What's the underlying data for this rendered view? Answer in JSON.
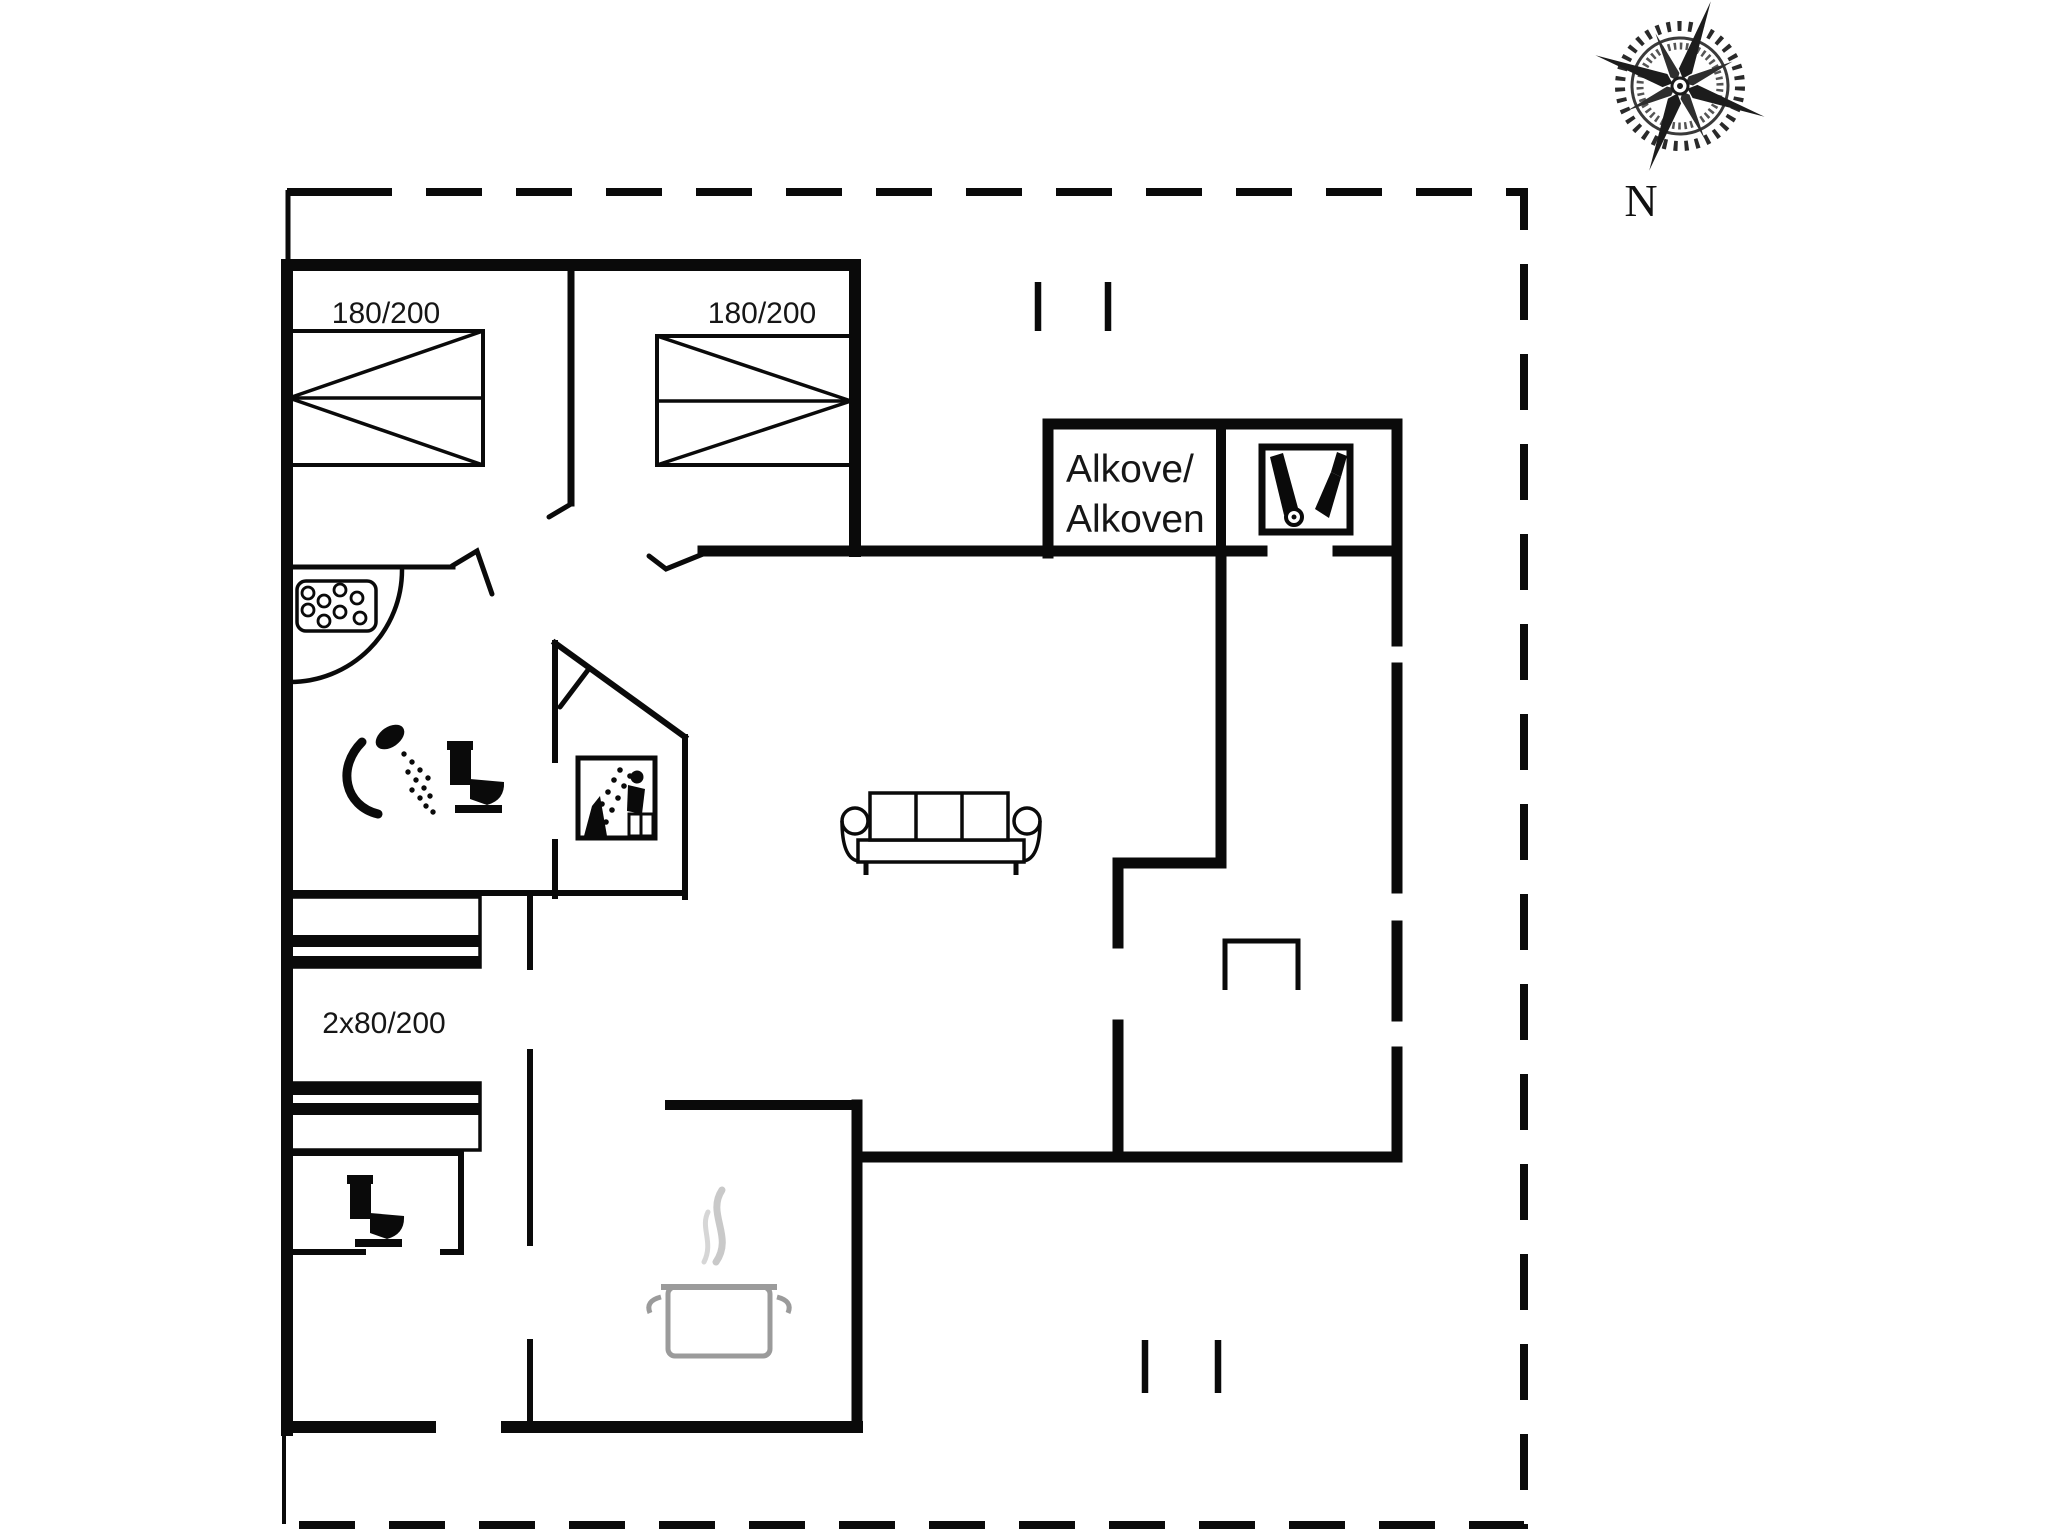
{
  "document": {
    "kind": "holiday-house floor plan"
  },
  "colors": {
    "background": "#ffffff",
    "ink": "#0a0a0a",
    "pot_outline": "#9b9b9b",
    "steam": "#c9c9c9",
    "compass_dark": "#1c1c1c"
  },
  "compass": {
    "label": "N"
  },
  "bed_labels": {
    "bedroom_left": "180/200",
    "bedroom_right": "180/200",
    "bunk_room": "2x80/200"
  },
  "alcove": {
    "line1": "Alkove/",
    "line2": "Alkoven"
  },
  "icons": [
    "compass-rose-icon",
    "whirlpool-icon",
    "shower-icon",
    "toilet-icon",
    "sauna-icon",
    "vacuum-cleaner-icon",
    "cooking-pot-icon",
    "sofa-symbol",
    "fireplace-symbol",
    "double-bed-symbol",
    "bunk-bed-symbol"
  ]
}
